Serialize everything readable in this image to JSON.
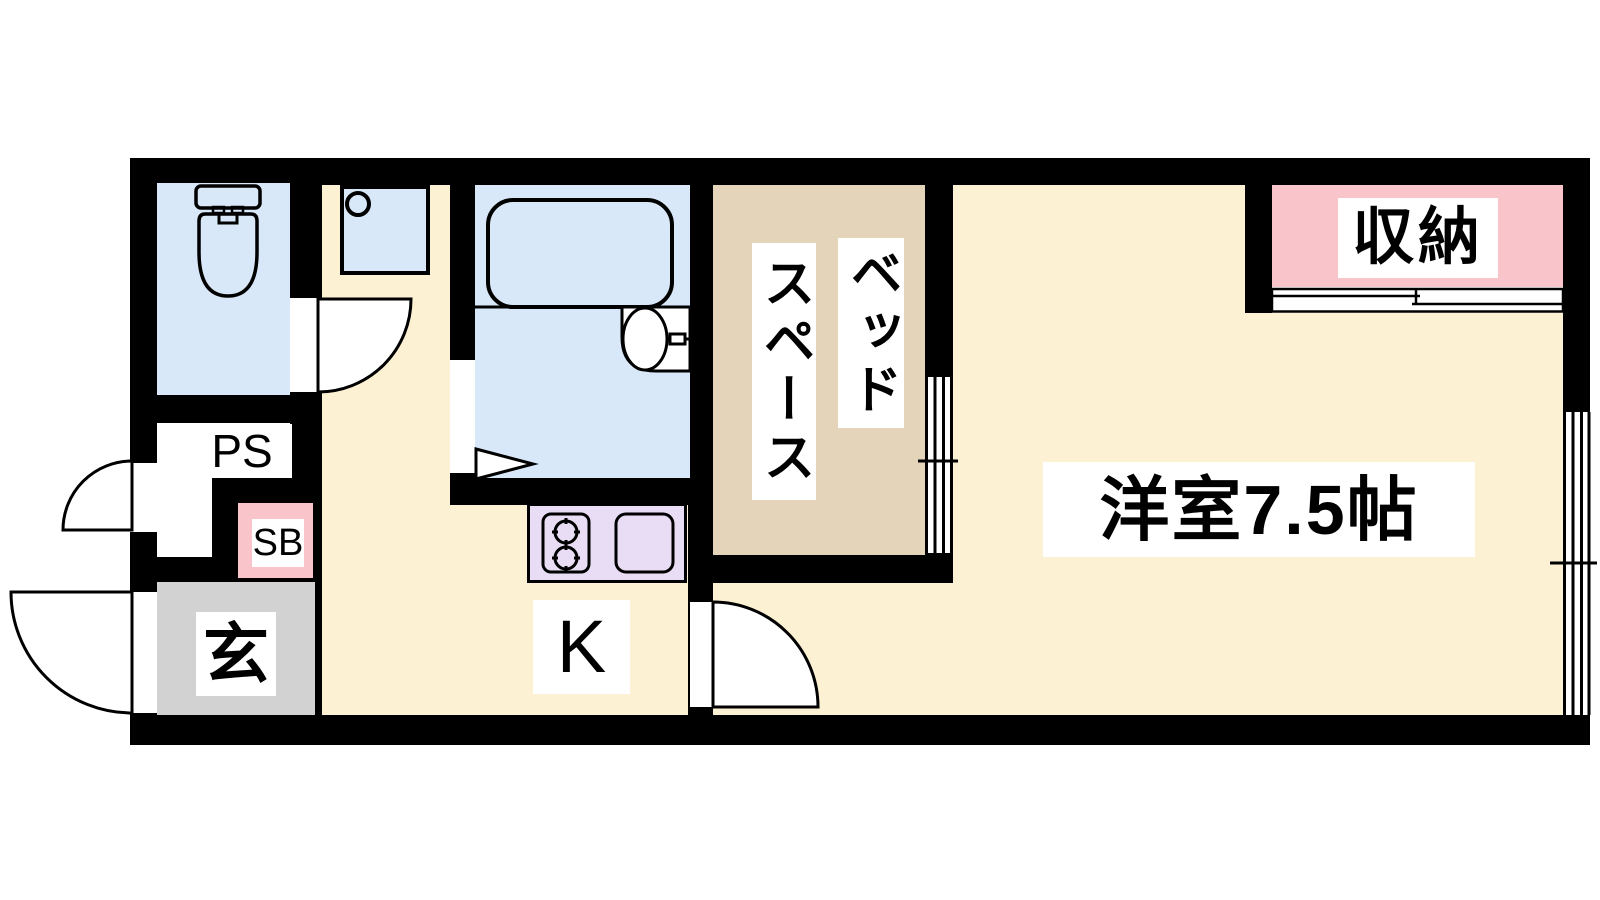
{
  "plan": {
    "type": "apartment-floor-plan",
    "rooms": {
      "western_room": {
        "label": "洋室7.5帖"
      },
      "closet": {
        "label": "収納"
      },
      "bed_space": {
        "label_right": "ベッド",
        "label_left": "スペース"
      },
      "kitchen": {
        "label": "K"
      },
      "entrance": {
        "label": "玄"
      },
      "shoe_box": {
        "label": "SB"
      },
      "pipe_space": {
        "label": "PS"
      }
    },
    "colors": {
      "wall": "#000000",
      "floor": "#FCF1D3",
      "wet_area": "#D9E8F8",
      "bed_space": "#E3D4BA",
      "accent_pink": "#FAC5CA",
      "kitchen_counter": "#E9DDF5",
      "entrance_gray": "#D2D2D2",
      "label_background": "#FFFFFF",
      "background": "#FFFFFF"
    },
    "icons": [
      "toilet-icon",
      "washbasin-icon",
      "bathtub-icon",
      "bath-sink-icon",
      "folding-door-icon",
      "door-swing-icon",
      "stove-icon",
      "kitchen-sink-icon",
      "sliding-door-icon",
      "sliding-window-icon"
    ]
  }
}
